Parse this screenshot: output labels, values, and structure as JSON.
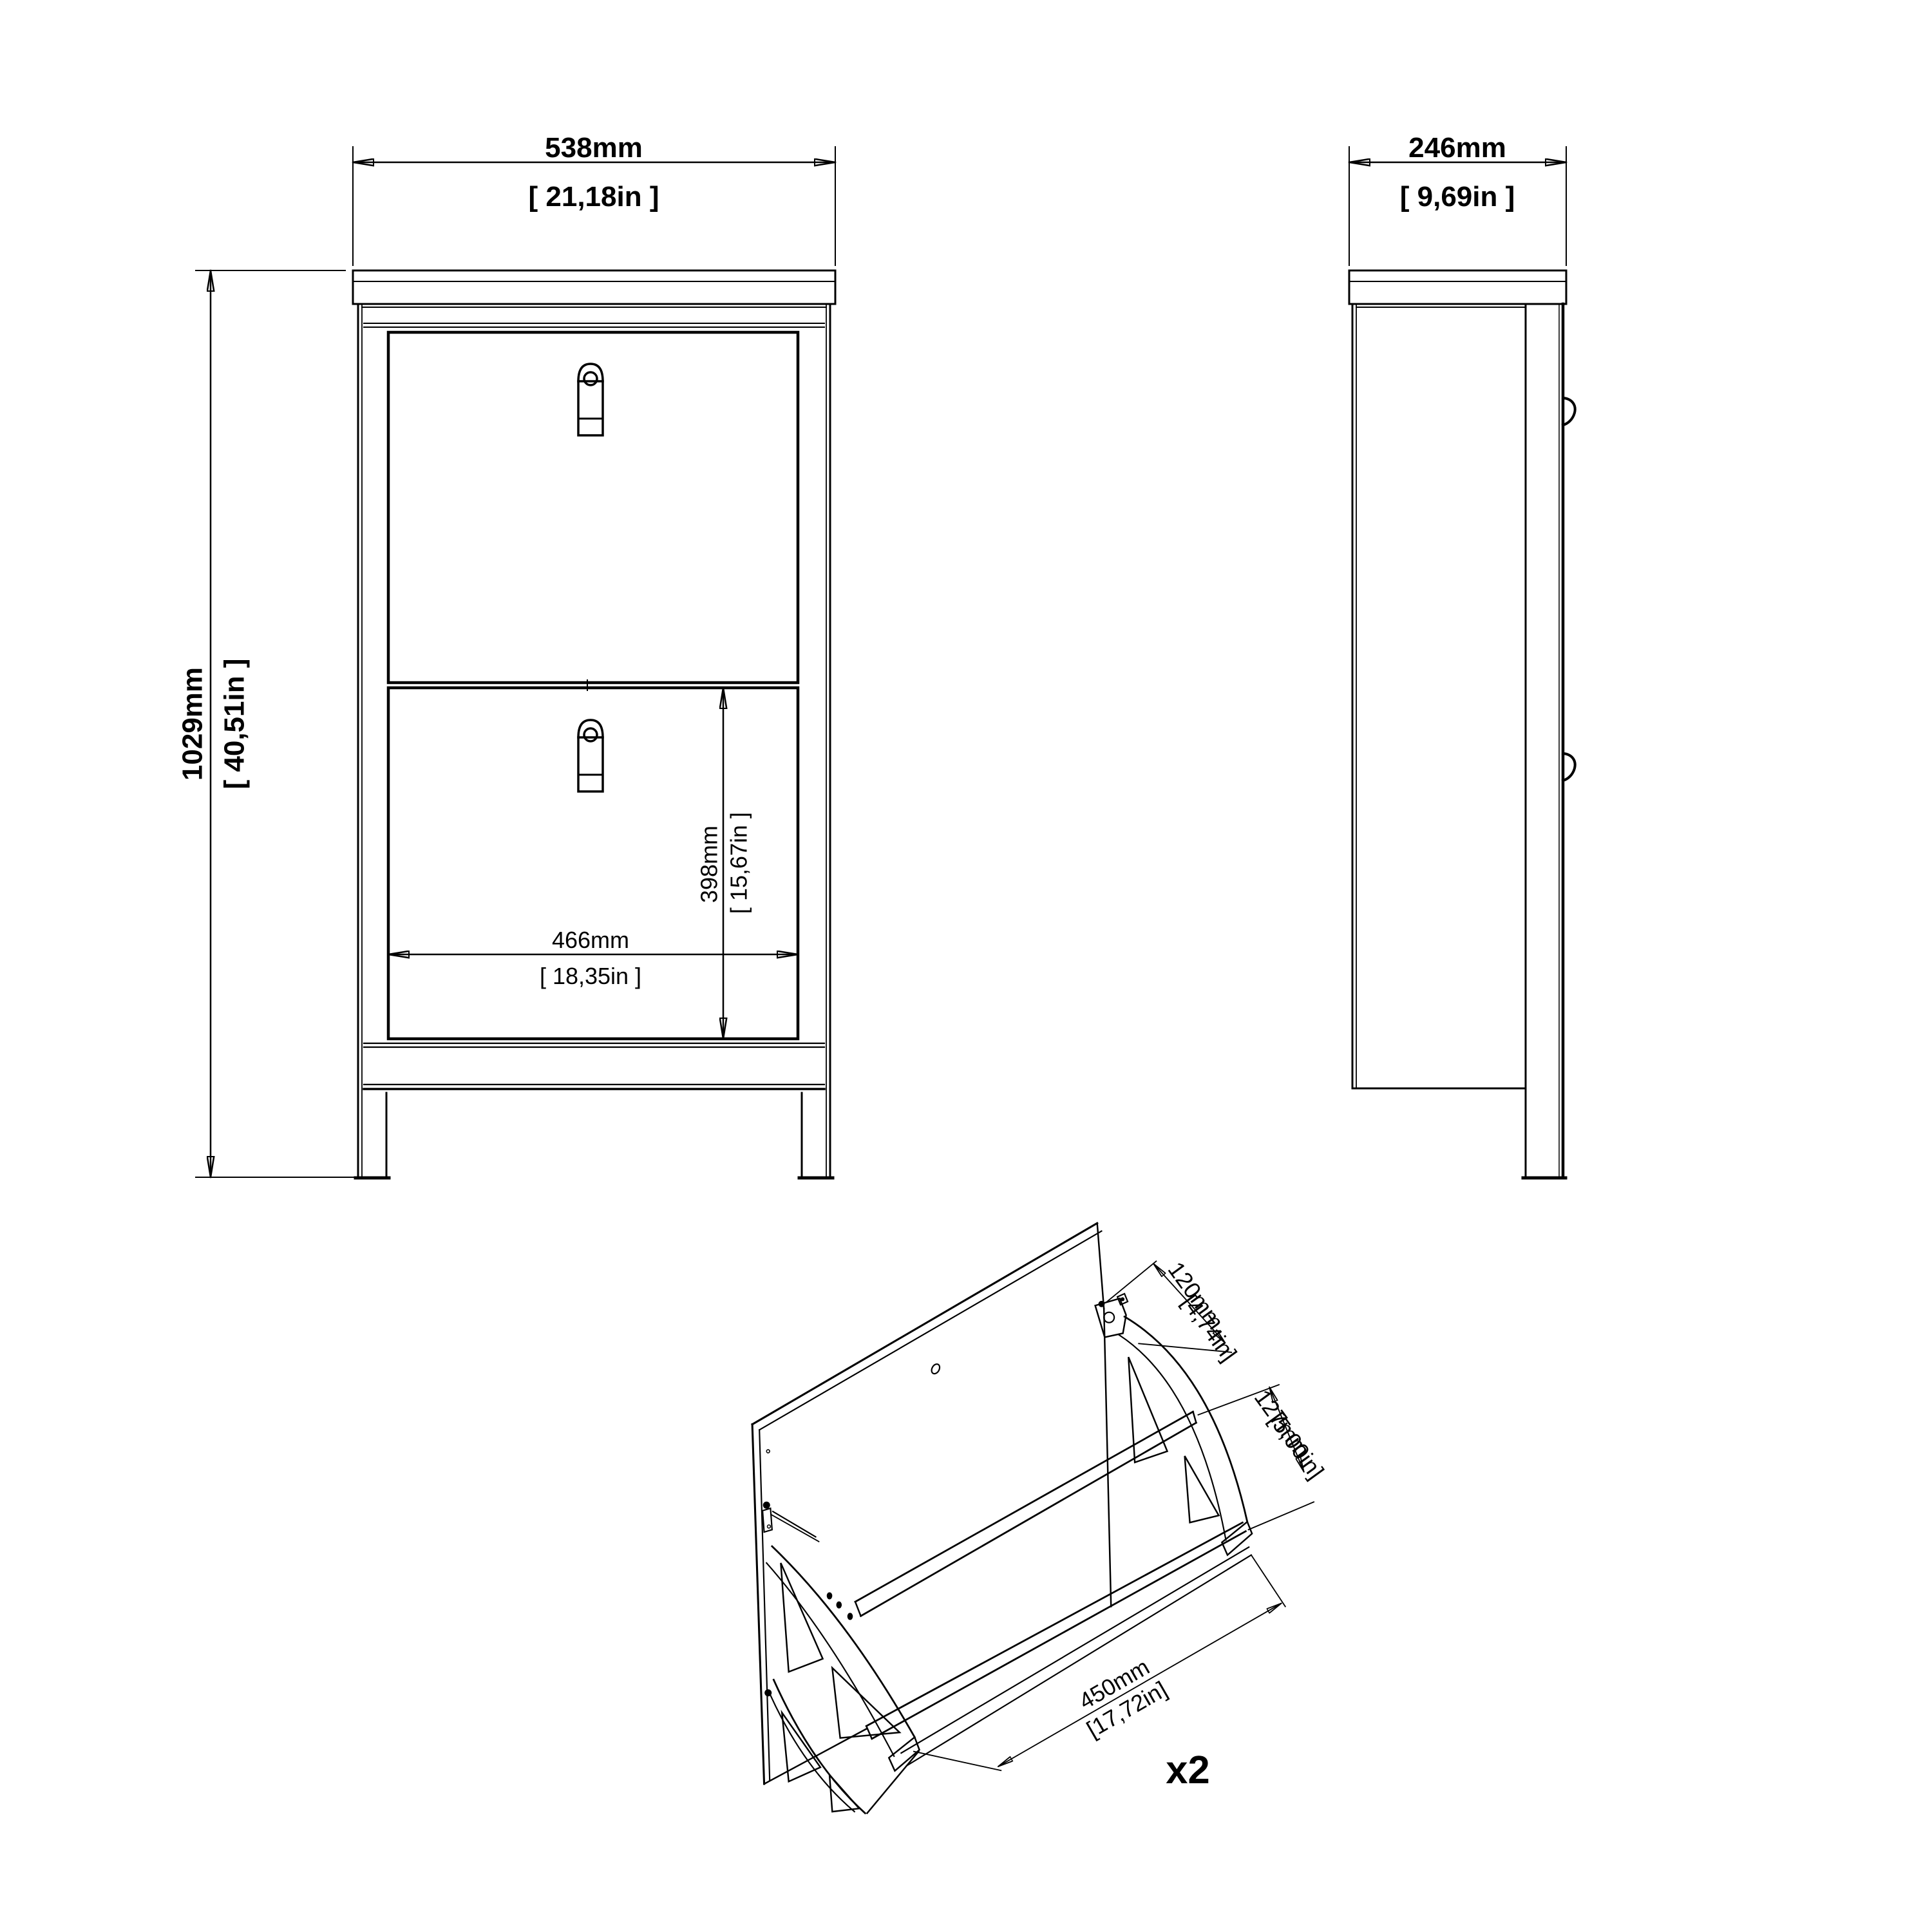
{
  "drawing": {
    "colors": {
      "line": "#000000",
      "background": "#ffffff"
    },
    "front_view": {
      "width_dim": {
        "mm": "538mm",
        "inch": "[ 21,18in ]"
      },
      "height_dim": {
        "mm": "1029mm",
        "inch": "[ 40,51in ]"
      },
      "inner_width_dim": {
        "mm": "466mm",
        "inch": "[ 18,35in ]"
      },
      "door_height_dim": {
        "mm": "398mm",
        "inch": "[ 15,67in ]"
      }
    },
    "side_view": {
      "depth_dim": {
        "mm": "246mm",
        "inch": "[ 9,69in ]"
      }
    },
    "flap_unit_view": {
      "hinge_dim": {
        "mm": "120mm",
        "inch": "[4,74in]"
      },
      "depth_dim": {
        "mm": "127mm",
        "inch": "[5,00in]"
      },
      "width_dim": {
        "mm": "450mm",
        "inch": "[17,72in]"
      },
      "quantity_label": "x2"
    }
  }
}
